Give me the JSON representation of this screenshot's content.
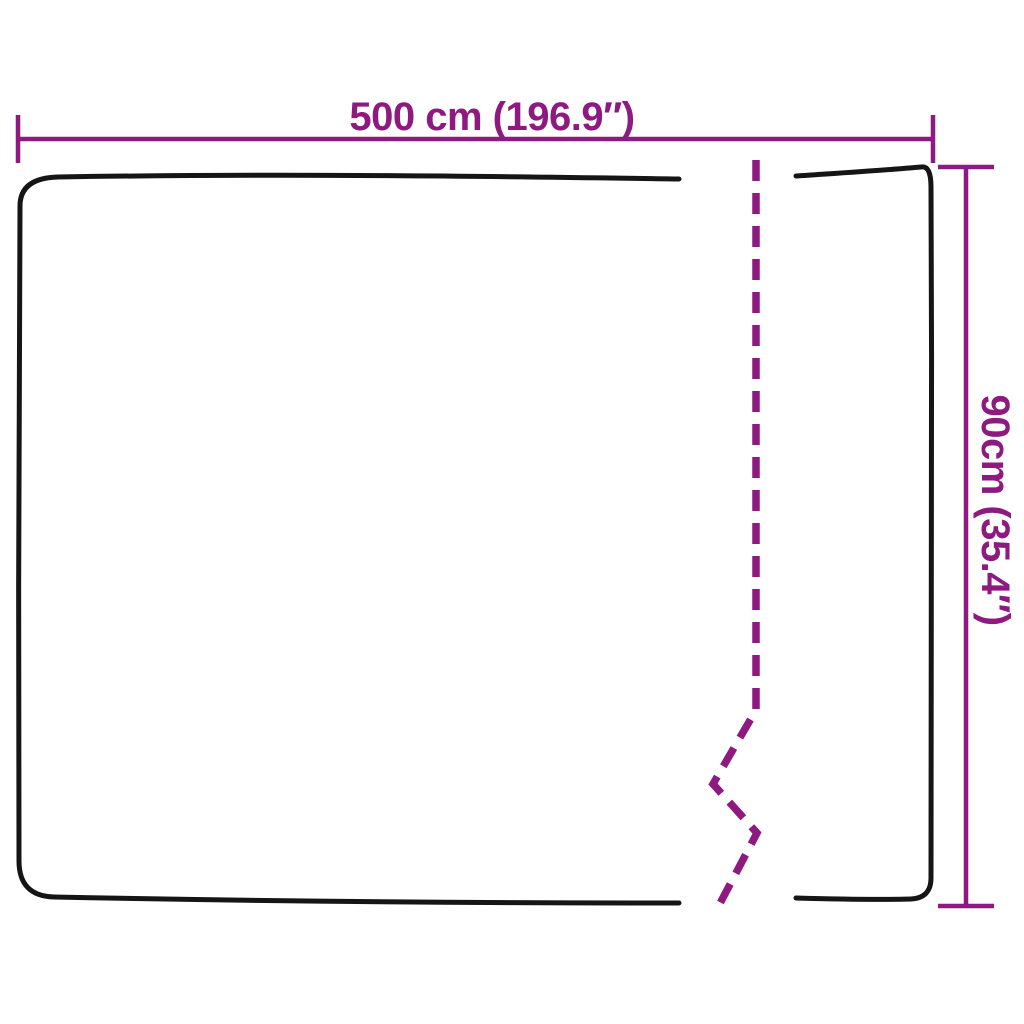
{
  "diagram": {
    "width_label": "500 cm (196.9″)",
    "height_label": "90cm (35.4″)"
  },
  "colors": {
    "dimension": "#8E1980",
    "outline": "#151515",
    "background": "#FFFFFF"
  }
}
